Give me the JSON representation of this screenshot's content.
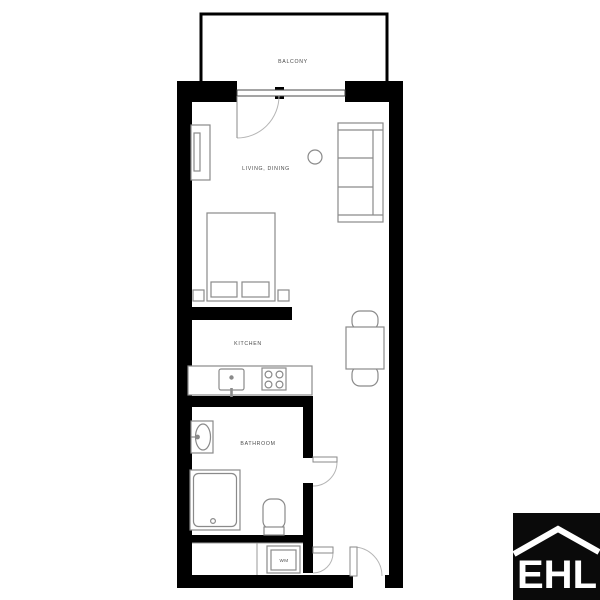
{
  "plan": {
    "labels": {
      "balcony": "BALCONY",
      "living": "LIVING, DINING",
      "kitchen": "KITCHEN",
      "bathroom": "BATHROOM",
      "wm": "WM"
    },
    "colors": {
      "wall": "#000000",
      "fixture": "#8a8a8a",
      "door_arc": "#b5b5b5",
      "label": "#4a4a4a",
      "window_frame": "#4a4a4a",
      "closet_line": "#9a9a9a"
    }
  },
  "logo": {
    "text": "EHL",
    "bg": "#0a0a0a",
    "fg": "#ffffff"
  }
}
